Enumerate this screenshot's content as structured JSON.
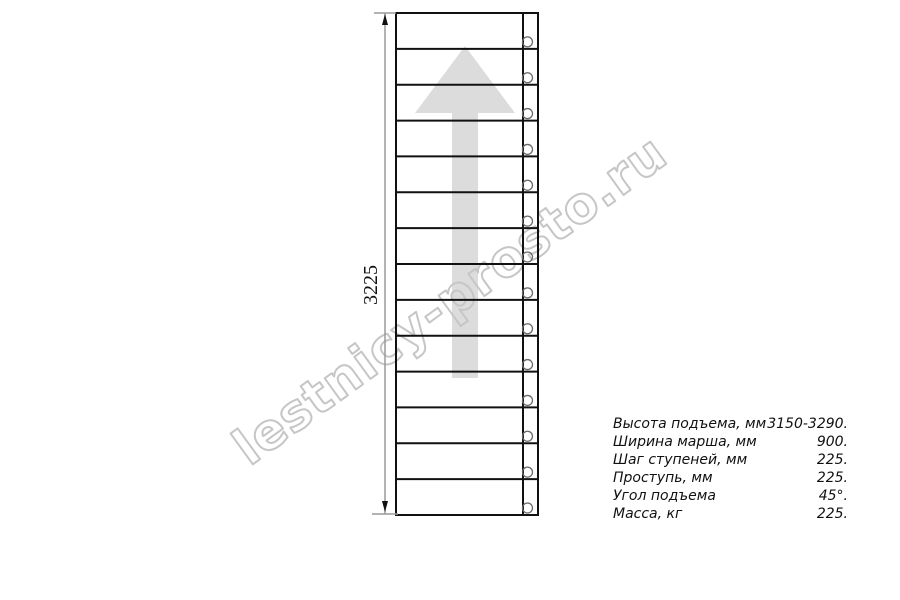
{
  "watermark": {
    "text": "lestnicy-prosto.ru",
    "color": "#c6c6c6"
  },
  "drawing": {
    "dimension_label": "3225",
    "steps_count": 14,
    "direction_arrow": "up-arrow",
    "colors": {
      "line": "#111111",
      "dimension_line": "#9a9a9a",
      "arrow_fill": "#dcdcdc",
      "hole_stroke": "#6a6a6a"
    }
  },
  "specs": {
    "rows": [
      {
        "label": "Высота подъема, мм",
        "value": "3150-3290."
      },
      {
        "label": "Ширина марша, мм",
        "value": "900."
      },
      {
        "label": "Шаг ступеней, мм",
        "value": "225."
      },
      {
        "label": "Проступь, мм",
        "value": "225."
      },
      {
        "label": "Угол подъема",
        "value": "45°."
      },
      {
        "label": "Масса, кг",
        "value": "225."
      }
    ]
  }
}
